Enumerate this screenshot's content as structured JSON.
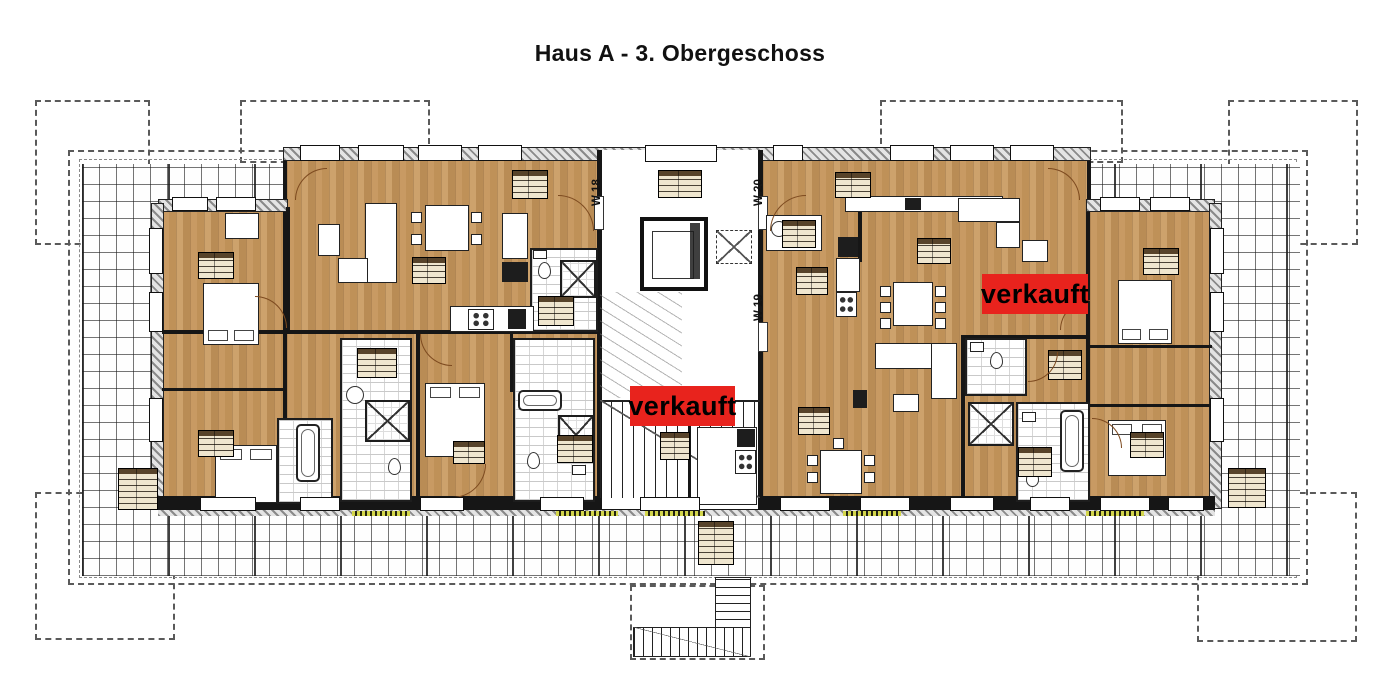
{
  "title": "Haus A - 3. Obergeschoss",
  "units": {
    "w18": "W 18",
    "w19": "W 19",
    "w20": "W 20"
  },
  "sold": {
    "label1": "verkauft",
    "label2": "verkauft"
  },
  "colors": {
    "sold_red": "#e8231d",
    "wood_floor": "#c49660",
    "wall_dark": "#161616",
    "terrace_line": "#444444"
  }
}
